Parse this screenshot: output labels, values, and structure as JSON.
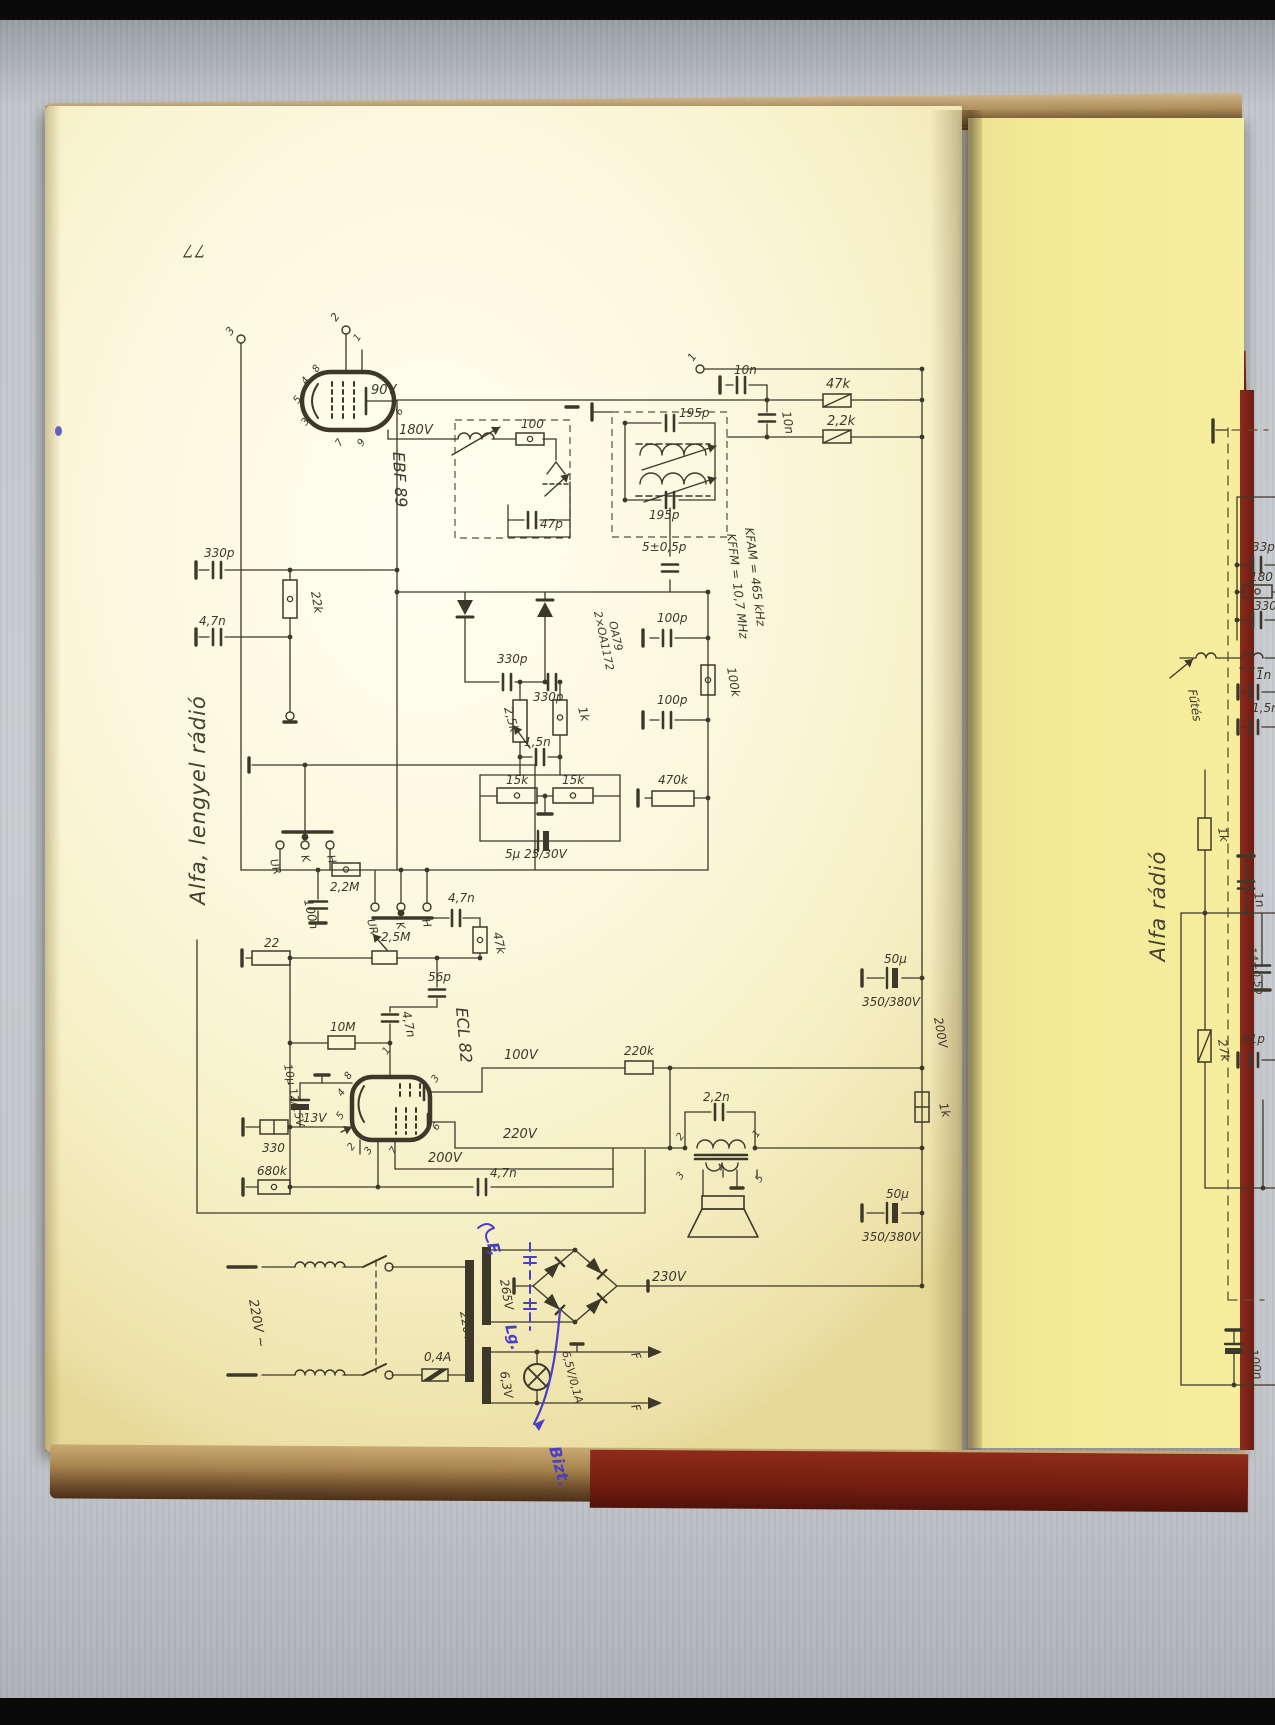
{
  "scan": {
    "page_number": "77",
    "left_page_margin_title": "Alfa, lengyel rádió",
    "right_page_margin_title": "Alfa rádió",
    "tubes": [
      "EBF 89",
      "ECL 82"
    ],
    "if_frequency_notes": [
      "KFAM = 465 kHz",
      "KFFM = 10,7 MHz"
    ],
    "handwritten_ink_notes": [
      "F,",
      "Lg.",
      "Bizt."
    ],
    "ink_color": "#3e382b",
    "handwriting_color": "#4a3fc6",
    "paper_color_left": "#fbf7dd",
    "paper_color_right": "#f3ea97",
    "cover_color": "#7c1f14"
  },
  "labels": [
    [
      "3",
      231,
      336,
      -55,
      11,
      ""
    ],
    [
      "2",
      336,
      322,
      -55,
      11,
      ""
    ],
    [
      "1",
      693,
      362,
      -55,
      11,
      ""
    ],
    [
      "90V",
      371,
      394,
      0,
      13,
      ""
    ],
    [
      "180V",
      399,
      434,
      0,
      13,
      ""
    ],
    [
      "EBF 89",
      393,
      452,
      87,
      16,
      ""
    ],
    [
      "1",
      358,
      342,
      -55,
      10,
      ""
    ],
    [
      "8",
      317,
      373,
      -55,
      10,
      ""
    ],
    [
      "4",
      306,
      385,
      -55,
      10,
      ""
    ],
    [
      "5",
      298,
      404,
      -55,
      10,
      ""
    ],
    [
      "3",
      306,
      426,
      -55,
      10,
      ""
    ],
    [
      "7",
      340,
      447,
      -55,
      10,
      ""
    ],
    [
      "9",
      362,
      447,
      -55,
      10,
      ""
    ],
    [
      "6",
      400,
      416,
      -55,
      10,
      ""
    ],
    [
      "100",
      521,
      428,
      0,
      12,
      ""
    ],
    [
      "47p",
      540,
      528,
      0,
      12,
      ""
    ],
    [
      "195p",
      679,
      417,
      0,
      12,
      ""
    ],
    [
      "195p",
      649,
      519,
      0,
      12,
      ""
    ],
    [
      "5±0,5p",
      642,
      551,
      0,
      12,
      ""
    ],
    [
      "10n",
      734,
      374,
      0,
      12,
      ""
    ],
    [
      "10n",
      782,
      412,
      80,
      12,
      ""
    ],
    [
      "47k",
      826,
      388,
      0,
      13,
      ""
    ],
    [
      "2,2k",
      827,
      425,
      0,
      13,
      ""
    ],
    [
      "KFAM = 465 kHz",
      745,
      528,
      83,
      12,
      ""
    ],
    [
      "KFFM = 10,7 MHz",
      727,
      534,
      83,
      12,
      ""
    ],
    [
      "330p",
      204,
      557,
      0,
      12,
      ""
    ],
    [
      "22k",
      311,
      592,
      80,
      12,
      ""
    ],
    [
      "4,7n",
      199,
      625,
      0,
      12,
      ""
    ],
    [
      "2×OA1172",
      594,
      612,
      78,
      11,
      ""
    ],
    [
      "OA79",
      609,
      622,
      78,
      11,
      ""
    ],
    [
      "330p",
      497,
      663,
      0,
      12,
      ""
    ],
    [
      "330p",
      533,
      701,
      0,
      12,
      ""
    ],
    [
      "2,5k",
      504,
      708,
      75,
      12,
      ""
    ],
    [
      "1k",
      578,
      708,
      75,
      12,
      ""
    ],
    [
      "1,5n",
      524,
      746,
      0,
      12,
      ""
    ],
    [
      "15k",
      506,
      784,
      0,
      12,
      ""
    ],
    [
      "15k",
      562,
      784,
      0,
      12,
      ""
    ],
    [
      "5μ 25/30V",
      505,
      858,
      0,
      12,
      ""
    ],
    [
      "100p",
      657,
      622,
      0,
      12,
      ""
    ],
    [
      "100k",
      727,
      668,
      80,
      12,
      ""
    ],
    [
      "100p",
      657,
      704,
      0,
      12,
      ""
    ],
    [
      "470k",
      658,
      784,
      0,
      12,
      ""
    ],
    [
      "UR",
      270,
      860,
      75,
      11,
      ""
    ],
    [
      "K",
      301,
      856,
      75,
      11,
      ""
    ],
    [
      "H",
      327,
      856,
      75,
      11,
      ""
    ],
    [
      "2,2M",
      330,
      891,
      0,
      12,
      ""
    ],
    [
      "100n",
      304,
      900,
      78,
      12,
      ""
    ],
    [
      "UR",
      367,
      920,
      75,
      11,
      ""
    ],
    [
      "K",
      396,
      923,
      75,
      11,
      ""
    ],
    [
      "H",
      422,
      920,
      75,
      11,
      ""
    ],
    [
      "4,7n",
      448,
      902,
      0,
      12,
      ""
    ],
    [
      "47k",
      493,
      933,
      78,
      12,
      ""
    ],
    [
      "22",
      264,
      947,
      0,
      12,
      ""
    ],
    [
      "2,5M",
      381,
      941,
      0,
      12,
      ""
    ],
    [
      "56p",
      428,
      981,
      0,
      12,
      ""
    ],
    [
      "10M",
      330,
      1031,
      0,
      12,
      ""
    ],
    [
      "4,7n",
      402,
      1012,
      78,
      12,
      ""
    ],
    [
      "ECL 82",
      456,
      1008,
      85,
      16,
      ""
    ],
    [
      "1",
      387,
      1055,
      -55,
      10,
      ""
    ],
    [
      "8",
      349,
      1080,
      -55,
      10,
      ""
    ],
    [
      "4",
      342,
      1097,
      -55,
      10,
      ""
    ],
    [
      "5",
      341,
      1120,
      -55,
      10,
      ""
    ],
    [
      "2",
      352,
      1151,
      -55,
      10,
      ""
    ],
    [
      "3",
      369,
      1155,
      -55,
      10,
      ""
    ],
    [
      "7",
      394,
      1155,
      -55,
      10,
      ""
    ],
    [
      "3",
      436,
      1083,
      -55,
      10,
      ""
    ],
    [
      "6",
      437,
      1131,
      -55,
      10,
      ""
    ],
    [
      "13V",
      303,
      1122,
      0,
      12,
      ""
    ],
    [
      "330",
      262,
      1152,
      0,
      12,
      ""
    ],
    [
      "680k",
      257,
      1175,
      0,
      12,
      ""
    ],
    [
      "10μ 12/15V",
      284,
      1065,
      78,
      11,
      ""
    ],
    [
      "100V",
      504,
      1059,
      0,
      13,
      ""
    ],
    [
      "220V",
      503,
      1138,
      0,
      13,
      ""
    ],
    [
      "200V",
      428,
      1162,
      0,
      13,
      ""
    ],
    [
      "4,7n",
      490,
      1177,
      0,
      12,
      ""
    ],
    [
      "220k",
      624,
      1055,
      0,
      12,
      ""
    ],
    [
      "2,2n",
      703,
      1101,
      0,
      12,
      ""
    ],
    [
      "2",
      681,
      1141,
      -55,
      10,
      ""
    ],
    [
      "1",
      757,
      1138,
      -55,
      10,
      ""
    ],
    [
      "3",
      681,
      1180,
      -55,
      10,
      ""
    ],
    [
      "4",
      722,
      1172,
      -55,
      10,
      ""
    ],
    [
      "5",
      760,
      1183,
      -55,
      10,
      ""
    ],
    [
      "50μ",
      884,
      963,
      0,
      12,
      ""
    ],
    [
      "350/380V",
      862,
      1006,
      0,
      12,
      ""
    ],
    [
      "200V",
      934,
      1018,
      80,
      12,
      ""
    ],
    [
      "1k",
      939,
      1104,
      75,
      12,
      ""
    ],
    [
      "50μ",
      886,
      1198,
      0,
      12,
      ""
    ],
    [
      "350/380V",
      862,
      1241,
      0,
      12,
      ""
    ],
    [
      "230V",
      652,
      1281,
      0,
      13,
      ""
    ],
    [
      "220V ~",
      249,
      1300,
      80,
      13,
      ""
    ],
    [
      "0,4A",
      424,
      1361,
      0,
      12,
      ""
    ],
    [
      "220V",
      460,
      1312,
      80,
      12,
      ""
    ],
    [
      "265V",
      500,
      1280,
      80,
      12,
      ""
    ],
    [
      "6,3V",
      500,
      1372,
      80,
      12,
      ""
    ],
    [
      "6,5V/0,1A",
      562,
      1352,
      75,
      11,
      ""
    ],
    [
      "F",
      631,
      1354,
      70,
      12,
      ""
    ],
    [
      "F",
      631,
      1406,
      70,
      12,
      ""
    ],
    [
      "F,",
      487,
      1244,
      75,
      16,
      "blue"
    ],
    [
      "Lg.",
      505,
      1326,
      75,
      15,
      "blue"
    ],
    [
      "Bizt.",
      549,
      1448,
      75,
      16,
      "blue"
    ],
    [
      "Fűtés",
      1188,
      690,
      80,
      12,
      ""
    ],
    [
      "33p",
      1252,
      551,
      0,
      12,
      ""
    ],
    [
      "180",
      1250,
      581,
      0,
      12,
      ""
    ],
    [
      "330p",
      1254,
      610,
      0,
      12,
      ""
    ],
    [
      "1n",
      1256,
      679,
      0,
      12,
      ""
    ],
    [
      "1,5n",
      1252,
      712,
      0,
      12,
      ""
    ],
    [
      "1k",
      1218,
      828,
      80,
      12,
      ""
    ],
    [
      "1n",
      1254,
      893,
      80,
      12,
      ""
    ],
    [
      "14±0,5p",
      1248,
      948,
      80,
      11,
      ""
    ],
    [
      "27k",
      1218,
      1040,
      80,
      12,
      ""
    ],
    [
      "91p",
      1242,
      1043,
      0,
      12,
      ""
    ],
    [
      "100n",
      1249,
      1350,
      80,
      12,
      ""
    ]
  ]
}
